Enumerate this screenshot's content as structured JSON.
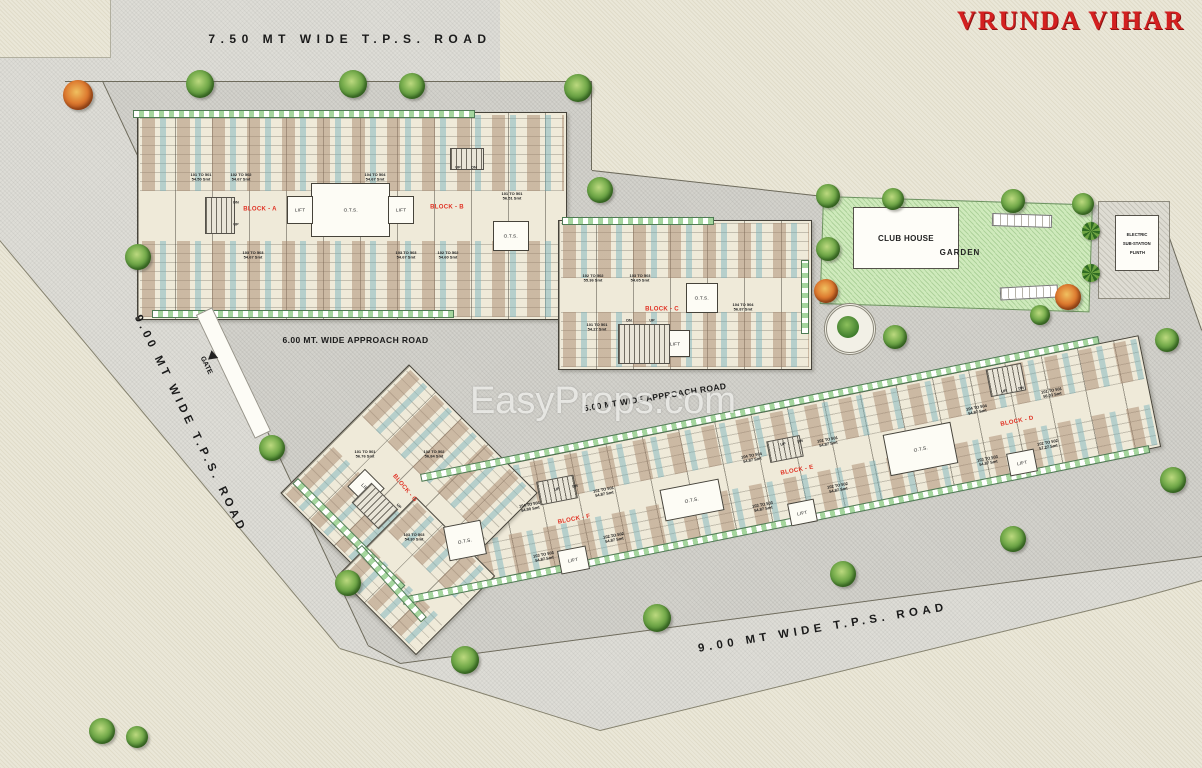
{
  "title": "VRUNDA VIHAR",
  "watermark": "EasyProps.com",
  "roads": {
    "top": "7.50 MT WIDE T.P.S. ROAD",
    "left": "9.00 MT WIDE T.P.S. ROAD",
    "bottom": "9.00 MT WIDE T.P.S. ROAD",
    "approach_mid": "6.00 MT. WIDE APPROACH ROAD",
    "approach_lower": "6.00 MT WIDE APPROACH ROAD"
  },
  "amenities": {
    "club_house": "CLUB HOUSE",
    "garden": "GARDEN",
    "substation_lines": [
      "ELECTRIC",
      "SUB-STATION",
      "PLINTH"
    ],
    "gate": "GATE"
  },
  "core_labels": {
    "ots": "O.T.S.",
    "lift": "LIFT",
    "up": "UP",
    "dn": "DN"
  },
  "blocks": [
    {
      "name": "BLOCK - A",
      "units": [
        {
          "range": "101 TO 501",
          "area": "54.50 Smt"
        },
        {
          "range": "102 TO 502",
          "area": "54.67 Smt"
        },
        {
          "range": "104 TO 504",
          "area": "54.67 Smt"
        },
        {
          "range": "103 TO 503",
          "area": "54.67 Smt"
        }
      ]
    },
    {
      "name": "BLOCK - B",
      "units": [
        {
          "range": "101 TO 501",
          "area": "56.51 Smt"
        },
        {
          "range": "103 TO 503",
          "area": "54.67 Smt"
        },
        {
          "range": "102 TO 502",
          "area": "54.60 Smt"
        }
      ]
    },
    {
      "name": "BLOCK - C",
      "units": [
        {
          "range": "102 TO 502",
          "area": "55.36 Smt"
        },
        {
          "range": "103 TO 503",
          "area": "54.65 Smt"
        },
        {
          "range": "104 TO 504",
          "area": "56.87 Smt"
        },
        {
          "range": "101 TO 501",
          "area": "54.27 Smt"
        }
      ]
    },
    {
      "name": "BLOCK - D",
      "units": [
        {
          "range": "101 TO 501",
          "area": "56.03 Smt"
        },
        {
          "range": "102 TO 502",
          "area": "57.27 Smt"
        },
        {
          "range": "103 TO 503",
          "area": "54.87 Smt"
        },
        {
          "range": "104 TO 504",
          "area": "54.87 Smt"
        }
      ]
    },
    {
      "name": "BLOCK - E",
      "units": [
        {
          "range": "101 TO 501",
          "area": "54.87 Smt"
        },
        {
          "range": "102 TO 502",
          "area": "54.87 Smt"
        },
        {
          "range": "103 TO 503",
          "area": "54.87 Smt"
        },
        {
          "range": "104 TO 504",
          "area": "54.87 Smt"
        }
      ]
    },
    {
      "name": "BLOCK - F",
      "units": [
        {
          "range": "101 TO 501",
          "area": "54.87 Smt"
        },
        {
          "range": "102 TO 502",
          "area": "54.87 Smt"
        },
        {
          "range": "103 TO 503",
          "area": "54.87 Smt"
        },
        {
          "range": "104 TO 504",
          "area": "54.90 Smt"
        }
      ]
    },
    {
      "name": "BLOCK - G",
      "units": [
        {
          "range": "101 TO 501",
          "area": "56.76 Smt"
        },
        {
          "range": "102 TO 502",
          "area": "56.84 Smt"
        },
        {
          "range": "103 TO 503",
          "area": "54.30 Smt"
        }
      ]
    }
  ],
  "colors": {
    "title_red": "#d32020",
    "block_label_red": "#e03224",
    "garden_green": "#cfeabc",
    "tree_green": "#5a9440",
    "tree_orange": "#dd7b30",
    "road_gray": "#deddd7",
    "site_gray": "#d3d2cc",
    "parcel_beige": "#eae7d8",
    "bath_blue": "#78b2bc",
    "room_tan": "#a8886e"
  }
}
